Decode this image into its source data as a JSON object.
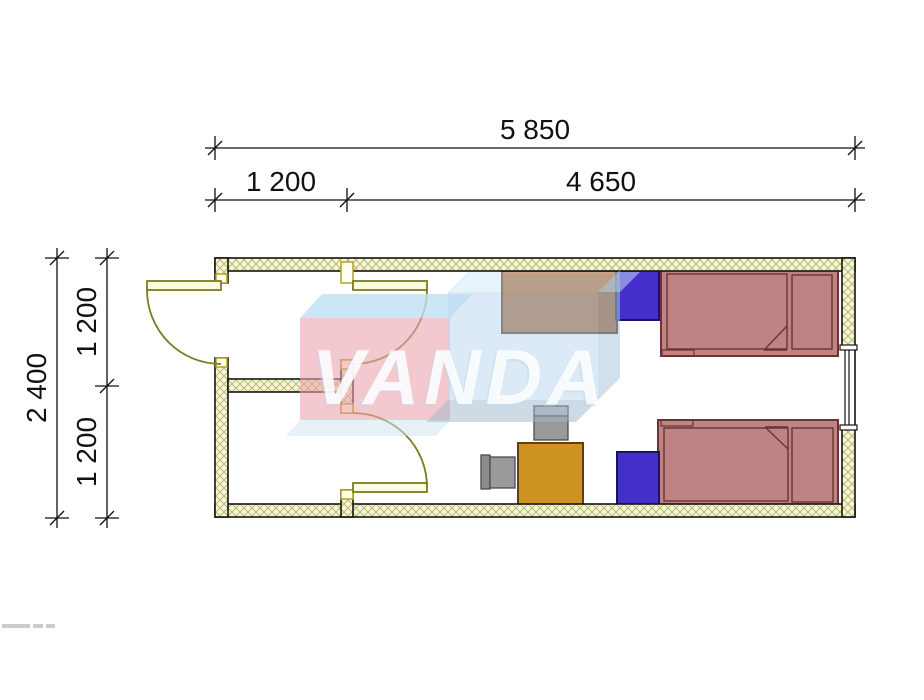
{
  "drawing": {
    "type": "floor-plan",
    "watermark_text": "VANDA",
    "dimensions": {
      "top": [
        {
          "label": "5 850",
          "role": "overall-width"
        },
        {
          "label": "1 200",
          "role": "entry-bay-width"
        },
        {
          "label": "4 650",
          "role": "main-room-width"
        }
      ],
      "left": [
        {
          "label": "2 400",
          "role": "overall-depth"
        },
        {
          "label": "1 200",
          "role": "upper-bay-depth"
        },
        {
          "label": "1 200",
          "role": "lower-bay-depth"
        }
      ]
    },
    "furniture": [
      "wardrobe",
      "nightstand",
      "bed",
      "bed",
      "nightstand",
      "desk",
      "chair",
      "chair"
    ],
    "doors": [
      "exterior-door",
      "upper-interior-door",
      "lower-interior-door"
    ],
    "window_count": 1,
    "colors": {
      "wall_fill": "#f6f6da",
      "wall_hatch": "#b9b96c",
      "door": "#7c7c20",
      "door_leaf_fill": "#fbfbe4",
      "jamb": "#b3a31c",
      "bed": "#bf8383",
      "bed_outline": "#6b3333",
      "nightstand": "#4330cc",
      "desk": "#ce9320",
      "wardrobe": "#a0561e",
      "wardrobe_top": "#c8590d",
      "chair_seat": "#9a9a9a",
      "chair_back": "#bdbdbd",
      "watermark_pink": "#eda3af",
      "watermark_blue": "#bdd9ee",
      "watermark_light": "#cfe8f6",
      "dim_line": "#111111"
    }
  }
}
